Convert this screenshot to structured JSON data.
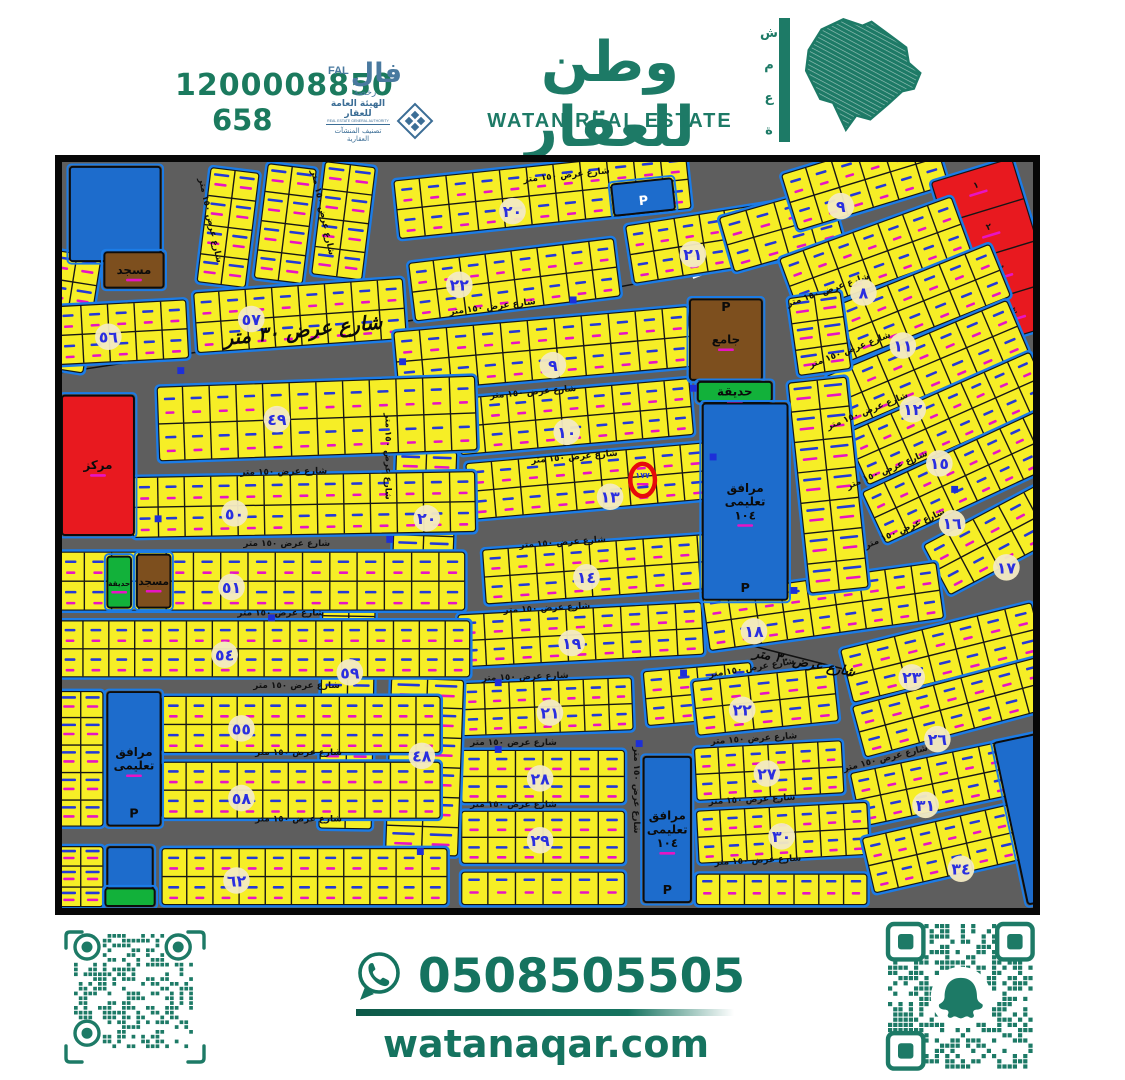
{
  "header": {
    "unified_number": "1200008850",
    "license_number": "658",
    "fal": {
      "ar": "فال",
      "en": "FAL",
      "sub": "رخصة"
    },
    "authority": {
      "line1": "الهيئة العامة للعقار",
      "line2": "REAL ESTATE GENERAL AUTHORITY",
      "line3": "تصنيف المنشآت العقارية"
    },
    "brand_ar": "وطن للعقار",
    "brand_en": "WATAN REAL ESTATE",
    "side_letters": [
      "ش",
      "م",
      "ع",
      "ة"
    ]
  },
  "footer": {
    "whatsapp_number": "0508505505",
    "website": "watanaqar.com"
  },
  "map": {
    "street_label": "شارع عرض ١٥٠ متر",
    "main_road_label": "شارع عرض ٣٠ متر",
    "highlight_plot": "١٧٧",
    "red_plot_labels": [
      "١",
      "٢",
      "٣",
      "٤"
    ],
    "labels": {
      "mosque_small": "مسجد",
      "mosque_large": "جامع",
      "park": "حديقة",
      "center": "مركز",
      "facility_1": "مرافق",
      "facility_2": "تعليمى",
      "facility_num": "١٠٤",
      "parking": "P"
    },
    "colors": {
      "street": "#5e5e5e",
      "plot": "#f6ee26",
      "blockStroke": "#1c7ce6",
      "line": "#161616",
      "blue": "#1d6ccc",
      "red": "#e8191f",
      "green": "#12b13a",
      "brown": "#7d4f1e",
      "circleFill": "#f2e9c2",
      "circleText": "#2a2ee0",
      "markBlue": "#2438d8",
      "markMagenta": "#e714c4",
      "highlight": "#e60b0b"
    },
    "blocks": [
      [
        "",
        150,
        4,
        52,
        120,
        7,
        0,
        0,
        1
      ],
      [
        "",
        208,
        0,
        52,
        120,
        7,
        0,
        0,
        1
      ],
      [
        "",
        266,
        -2,
        54,
        118,
        7,
        0,
        0,
        1
      ],
      [
        "",
        -10,
        88,
        52,
        122,
        9,
        0,
        0,
        1
      ],
      [
        "٥٦",
        -8,
        146,
        135,
        62,
        -3,
        47,
        178,
        0
      ],
      [
        "٥٧",
        132,
        132,
        215,
        64,
        -4,
        192,
        160,
        0
      ],
      [
        "٢٢",
        350,
        102,
        212,
        62,
        -7,
        403,
        125,
        0
      ],
      [
        "٢١",
        570,
        64,
        205,
        62,
        -9,
        640,
        94,
        0
      ],
      [
        "٢٠",
        335,
        18,
        300,
        62,
        -6,
        457,
        50,
        0
      ],
      [
        "",
        665,
        56,
        118,
        60,
        -16,
        0,
        0,
        0
      ],
      [
        "٩",
        728,
        12,
        162,
        62,
        -17,
        790,
        45,
        0
      ],
      [
        "",
        880,
        20,
        88,
        178,
        -17,
        0,
        0,
        3
      ],
      [
        "٨",
        726,
        98,
        188,
        62,
        -20,
        813,
        133,
        0
      ],
      [
        "١١",
        758,
        156,
        198,
        60,
        -22,
        853,
        187,
        0
      ],
      [
        "١٢",
        773,
        218,
        202,
        60,
        -23,
        863,
        252,
        0
      ],
      [
        "١٥",
        793,
        276,
        207,
        60,
        -24,
        890,
        307,
        0
      ],
      [
        "١٦",
        810,
        336,
        207,
        60,
        -25,
        903,
        368,
        0
      ],
      [
        "١٧",
        872,
        390,
        175,
        60,
        -28,
        958,
        413,
        0
      ],
      [
        "٩",
        335,
        172,
        302,
        64,
        -5,
        498,
        207,
        0
      ],
      [
        "١٠",
        398,
        240,
        240,
        60,
        -5,
        512,
        275,
        0
      ],
      [
        "١٣",
        408,
        306,
        247,
        60,
        -5,
        556,
        341,
        0
      ],
      [
        "٢٠",
        338,
        292,
        64,
        146,
        2,
        370,
        363,
        1
      ],
      [
        "١٤",
        425,
        394,
        247,
        58,
        -4,
        532,
        423,
        0
      ],
      [
        "١٩",
        400,
        460,
        250,
        56,
        -3,
        517,
        490,
        0
      ],
      [
        "٢١",
        403,
        530,
        176,
        56,
        -2,
        495,
        561,
        0
      ],
      [
        "",
        588,
        518,
        112,
        58,
        -5,
        0,
        0,
        0
      ],
      [
        "٢٨",
        404,
        598,
        168,
        56,
        0,
        485,
        628,
        0
      ],
      [
        "٢٩",
        404,
        660,
        168,
        56,
        0,
        485,
        691,
        0
      ],
      [
        "",
        404,
        722,
        168,
        36,
        0,
        0,
        0,
        2
      ],
      [
        "٤٨",
        333,
        524,
        76,
        182,
        2,
        365,
        605,
        1
      ],
      [
        "٥٩",
        264,
        400,
        56,
        280,
        1,
        292,
        520,
        1
      ],
      [
        "٤٩",
        95,
        228,
        325,
        78,
        -2,
        218,
        262,
        0
      ],
      [
        "٥٠",
        70,
        320,
        350,
        64,
        -1,
        175,
        358,
        0
      ],
      [
        "٥١",
        -5,
        396,
        415,
        62,
        0,
        172,
        433,
        0
      ],
      [
        "٥٤",
        -5,
        466,
        420,
        60,
        0,
        165,
        502,
        0
      ],
      [
        "٥٥",
        100,
        543,
        285,
        60,
        0,
        182,
        577,
        0
      ],
      [
        "٥٨",
        100,
        610,
        285,
        60,
        0,
        182,
        648,
        0
      ],
      [
        "٦٢",
        100,
        698,
        292,
        60,
        0,
        177,
        732,
        0
      ],
      [
        "",
        -5,
        538,
        48,
        140,
        0,
        0,
        0,
        1
      ],
      [
        "",
        -5,
        696,
        48,
        64,
        0,
        0,
        0,
        1
      ],
      [
        "١٨",
        648,
        440,
        242,
        60,
        -8,
        702,
        478,
        0
      ],
      [
        "٢٣",
        788,
        496,
        202,
        58,
        -14,
        862,
        525,
        0
      ],
      [
        "٢٢",
        638,
        528,
        146,
        58,
        -6,
        690,
        558,
        0
      ],
      [
        "٢٦",
        800,
        554,
        202,
        56,
        -15,
        888,
        588,
        0
      ],
      [
        "٢٧",
        640,
        596,
        152,
        56,
        -3,
        715,
        623,
        0
      ],
      [
        "٣١",
        798,
        622,
        188,
        58,
        -12,
        876,
        655,
        0
      ],
      [
        "٣٠",
        642,
        660,
        176,
        56,
        -3,
        730,
        687,
        0
      ],
      [
        "٣٤",
        810,
        688,
        207,
        60,
        -13,
        912,
        720,
        0
      ],
      [
        "",
        642,
        724,
        176,
        34,
        0,
        0,
        0,
        2
      ],
      [
        "",
        735,
        224,
        62,
        218,
        -6,
        0,
        0,
        1
      ],
      [
        "",
        735,
        138,
        56,
        82,
        -8,
        0,
        0,
        1
      ]
    ],
    "specials": [
      {
        "t": "blue",
        "x": 8,
        "y": 5,
        "w": 92,
        "h": 96,
        "lines": []
      },
      {
        "t": "brown",
        "x": 43,
        "y": 92,
        "w": 60,
        "h": 36,
        "lines": [
          "مسجد"
        ]
      },
      {
        "t": "blue",
        "x": 557,
        "y": 23,
        "w": 62,
        "h": 32,
        "r": -6,
        "lines": [],
        "p": true,
        "pc": "#ffffff"
      },
      {
        "t": "brown",
        "x": 637,
        "y": 140,
        "w": 73,
        "h": 82,
        "lines": [
          "جامع"
        ],
        "p": true
      },
      {
        "t": "green",
        "x": 645,
        "y": 224,
        "w": 75,
        "h": 20,
        "lines": [
          "حديقة"
        ]
      },
      {
        "t": "blue",
        "x": 650,
        "y": 246,
        "w": 86,
        "h": 200,
        "lines": [
          "مرافق",
          "تعليمى",
          "١٠٤"
        ],
        "p": true
      },
      {
        "t": "red",
        "x": 0,
        "y": 238,
        "w": 73,
        "h": 142,
        "lines": [
          "مركز"
        ]
      },
      {
        "t": "green",
        "x": 46,
        "y": 402,
        "w": 24,
        "h": 52,
        "lines": [
          "حديقة"
        ]
      },
      {
        "t": "brown",
        "x": 76,
        "y": 400,
        "w": 34,
        "h": 54,
        "lines": [
          "مسجد"
        ]
      },
      {
        "t": "blue",
        "x": 46,
        "y": 540,
        "w": 54,
        "h": 136,
        "lines": [
          "مرافق",
          "تعليمى"
        ],
        "p": true
      },
      {
        "t": "blue",
        "x": 46,
        "y": 698,
        "w": 46,
        "h": 44,
        "lines": []
      },
      {
        "t": "green",
        "x": 44,
        "y": 740,
        "w": 50,
        "h": 18,
        "lines": []
      },
      {
        "t": "blue",
        "x": 590,
        "y": 606,
        "w": 48,
        "h": 148,
        "lines": [
          "مرافق",
          "تعليمى",
          "١٠٤"
        ],
        "p": true
      },
      {
        "t": "blue",
        "x": 945,
        "y": 592,
        "w": 82,
        "h": 168,
        "r": -12,
        "lines": [],
        "p": true
      }
    ],
    "street_label_positions": [
      [
        437,
        150,
        -7
      ],
      [
        512,
        16,
        -6
      ],
      [
        478,
        237,
        -5
      ],
      [
        520,
        303,
        -5
      ],
      [
        508,
        390,
        -4
      ],
      [
        492,
        457,
        -3
      ],
      [
        470,
        527,
        -2
      ],
      [
        458,
        594,
        0
      ],
      [
        458,
        657,
        0
      ],
      [
        225,
        318,
        -1
      ],
      [
        228,
        391,
        0
      ],
      [
        222,
        462,
        0
      ],
      [
        238,
        536,
        0
      ],
      [
        240,
        604,
        0
      ],
      [
        240,
        672,
        0
      ],
      [
        778,
        133,
        -19
      ],
      [
        800,
        194,
        -21
      ],
      [
        818,
        256,
        -22
      ],
      [
        838,
        316,
        -23
      ],
      [
        856,
        376,
        -24
      ],
      [
        700,
        518,
        -9
      ],
      [
        702,
        590,
        -4
      ],
      [
        700,
        652,
        -3
      ],
      [
        706,
        714,
        -3
      ],
      [
        836,
        610,
        -14
      ],
      [
        148,
        60,
        78
      ],
      [
        262,
        52,
        78
      ],
      [
        580,
        640,
        90
      ],
      [
        328,
        300,
        90
      ]
    ],
    "main_road_labels": [
      {
        "x": 245,
        "y": 178,
        "r": -6,
        "s": 20
      },
      {
        "x": 752,
        "y": 514,
        "r": 11,
        "s": 13
      }
    ],
    "road_lines": [
      {
        "d": "M-10,216 C 300,168 560,136 700,98 C 780,72 830,28 858,-8",
        "w": 1.5,
        "c": "#111111"
      },
      {
        "d": "M640,118 C 720,88 790,50 845,-8",
        "w": 2.2,
        "c": "#ffffff",
        "dash": "9,7"
      },
      {
        "d": "M612,470 C 750,506 880,540 995,562",
        "w": 1.5,
        "c": "#111111"
      }
    ],
    "dots": [
      [
        345,
        203
      ],
      [
        518,
        140
      ],
      [
        640,
        230
      ],
      [
        332,
        384
      ],
      [
        97,
        363
      ],
      [
        630,
        520
      ],
      [
        363,
        702
      ],
      [
        585,
        592
      ],
      [
        905,
        333
      ],
      [
        212,
        464
      ],
      [
        442,
        598
      ],
      [
        442,
        530
      ],
      [
        742,
        436
      ],
      [
        120,
        212
      ],
      [
        660,
        300
      ]
    ],
    "highlight": {
      "x": 589,
      "y": 324,
      "rx": 12.5,
      "ry": 16.5
    }
  }
}
